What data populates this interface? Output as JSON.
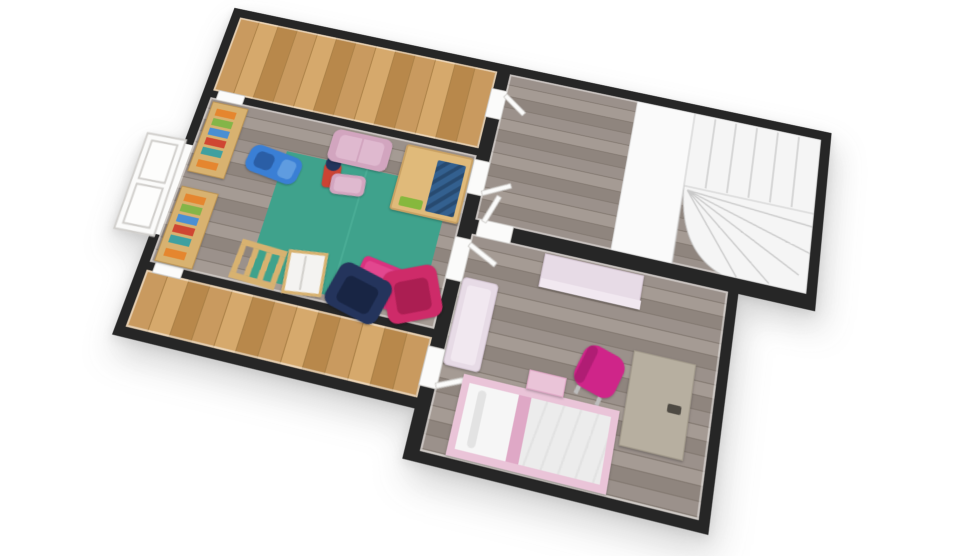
{
  "meta": {
    "title": "3D floor plan render - upper floor",
    "view": "top-down 3d dollhouse view",
    "rotation_deg": 13,
    "background": "plain white"
  },
  "colors": {
    "bg": "#ffffff",
    "wall": "#262626",
    "shadow": "rgba(70,70,70,0.22)",
    "wood_a": "#c99a5f",
    "wood_b": "#b8884b",
    "wood_c": "#d6a96c",
    "wood_line": "#a97f45",
    "gray_a": "#9b918b",
    "gray_b": "#8f857e",
    "gray_c": "#a59b94",
    "gray_line": "#837971",
    "door": "#fbfbfa",
    "door_edge": "#cfcdca",
    "stair": "#f5f5f5",
    "stair_line": "#c9c9c9",
    "landing": "#fafafa",
    "rug": "#3fa28c",
    "rug_light": "#49ac95",
    "pouf": "#d9327f",
    "armchair_pink": "#ce2b69",
    "armchair_pink_dark": "#ab1e52",
    "navy": "#24345c",
    "navy_dark": "#182544",
    "mauve": "#d2a5bf",
    "mauve_light": "#dfb9cf",
    "magenta": "#cf2589",
    "pale_pink": "#e7dbe6",
    "pale_pink_light": "#f1e8f0",
    "bed_frame": "#eac4d8",
    "bed_frame_dark": "#dfa8c6",
    "bedding": "#ebebeb",
    "pillow": "#f6f6f6",
    "desk": "#b7afa0",
    "desk_item": "#4e4a43",
    "toy_wood": "#d8b270",
    "table_wood": "#e0ba7a",
    "table_blue": "#33608f",
    "table_blue_dark": "#274a70",
    "toy_blue": "#3a7fd5",
    "toy_blue_dark": "#2a5ea6",
    "toy_red": "#cc4333",
    "lime": "#86b83d",
    "book_orange": "#e5862f",
    "book_green": "#84b548",
    "book_blue": "#4a8fd3",
    "book_red": "#cf4632",
    "book_teal": "#3fa0a0"
  },
  "rooms": [
    {
      "id": "attic-strip-top",
      "label": "attic storage strip (top)",
      "floor": "oak plank"
    },
    {
      "id": "playroom",
      "label": "playroom",
      "floor": "gray plank",
      "rug": "teal area rug"
    },
    {
      "id": "attic-strip-bottom",
      "label": "attic storage strip (bottom)",
      "floor": "oak plank"
    },
    {
      "id": "stair-hall",
      "label": "stair hall",
      "floor": "gray plank",
      "feature": "white winder staircase with landing"
    },
    {
      "id": "bedroom",
      "label": "kids bedroom",
      "floor": "gray plank"
    }
  ],
  "furniture": [
    {
      "room": "playroom",
      "item": "bookshelf upper (left wall)",
      "color_key": "toy_wood + book colors"
    },
    {
      "room": "playroom",
      "item": "bookshelf lower (left wall)",
      "color_key": "toy_wood + book colors"
    },
    {
      "room": "playroom",
      "item": "blue ride-on toy car",
      "color_key": "toy_blue"
    },
    {
      "room": "playroom",
      "item": "small toy trike/figure",
      "color_key": "toy_red + navy"
    },
    {
      "room": "playroom",
      "item": "mauve loveseat",
      "color_key": "mauve"
    },
    {
      "room": "playroom",
      "item": "mauve ottoman",
      "color_key": "mauve"
    },
    {
      "room": "playroom",
      "item": "wooden activity table with blue play top",
      "color_key": "table_wood + table_blue + lime"
    },
    {
      "room": "playroom",
      "item": "teal area rug",
      "color_key": "rug"
    },
    {
      "room": "playroom",
      "item": "hot pink square pouf",
      "color_key": "pouf"
    },
    {
      "room": "playroom",
      "item": "hot pink kids armchair",
      "color_key": "armchair_pink"
    },
    {
      "room": "playroom",
      "item": "navy kids armchair",
      "color_key": "navy"
    },
    {
      "room": "playroom",
      "item": "wooden ladder toy",
      "color_key": "toy_wood"
    },
    {
      "room": "playroom",
      "item": "toy slide board",
      "color_key": "white + toy_wood"
    },
    {
      "room": "stair-hall",
      "item": "white winder staircase with landing",
      "color_key": "stair"
    },
    {
      "room": "bedroom",
      "item": "pale pink dresser",
      "color_key": "pale_pink"
    },
    {
      "room": "bedroom",
      "item": "pale pink bench",
      "color_key": "pale_pink"
    },
    {
      "room": "bedroom",
      "item": "greige desk with dark accessory",
      "color_key": "desk"
    },
    {
      "room": "bedroom",
      "item": "magenta swivel chair",
      "color_key": "magenta"
    },
    {
      "room": "bedroom",
      "item": "pink single bed with white bedding",
      "color_key": "bed_frame"
    },
    {
      "room": "bedroom",
      "item": "pink nightstand",
      "color_key": "bed_frame"
    }
  ],
  "openings": [
    {
      "id": "door-top-strip-left",
      "between": [
        "playroom",
        "attic-strip-top"
      ]
    },
    {
      "id": "door-bottom-strip-left",
      "between": [
        "playroom",
        "attic-strip-bottom"
      ]
    },
    {
      "id": "door-top-strip-stair",
      "between": [
        "attic-strip-top",
        "stair-hall"
      ]
    },
    {
      "id": "door-playroom-stair",
      "between": [
        "playroom",
        "stair-hall"
      ]
    },
    {
      "id": "door-playroom-bedroom",
      "between": [
        "playroom",
        "bedroom"
      ]
    },
    {
      "id": "door-bottom-strip-bedroom",
      "between": [
        "attic-strip-bottom",
        "bedroom"
      ]
    },
    {
      "id": "door-stair-bedroom",
      "between": [
        "stair-hall",
        "bedroom"
      ]
    },
    {
      "id": "window-playroom-left",
      "wall": "playroom left exterior wall",
      "type": "white casement window"
    }
  ]
}
